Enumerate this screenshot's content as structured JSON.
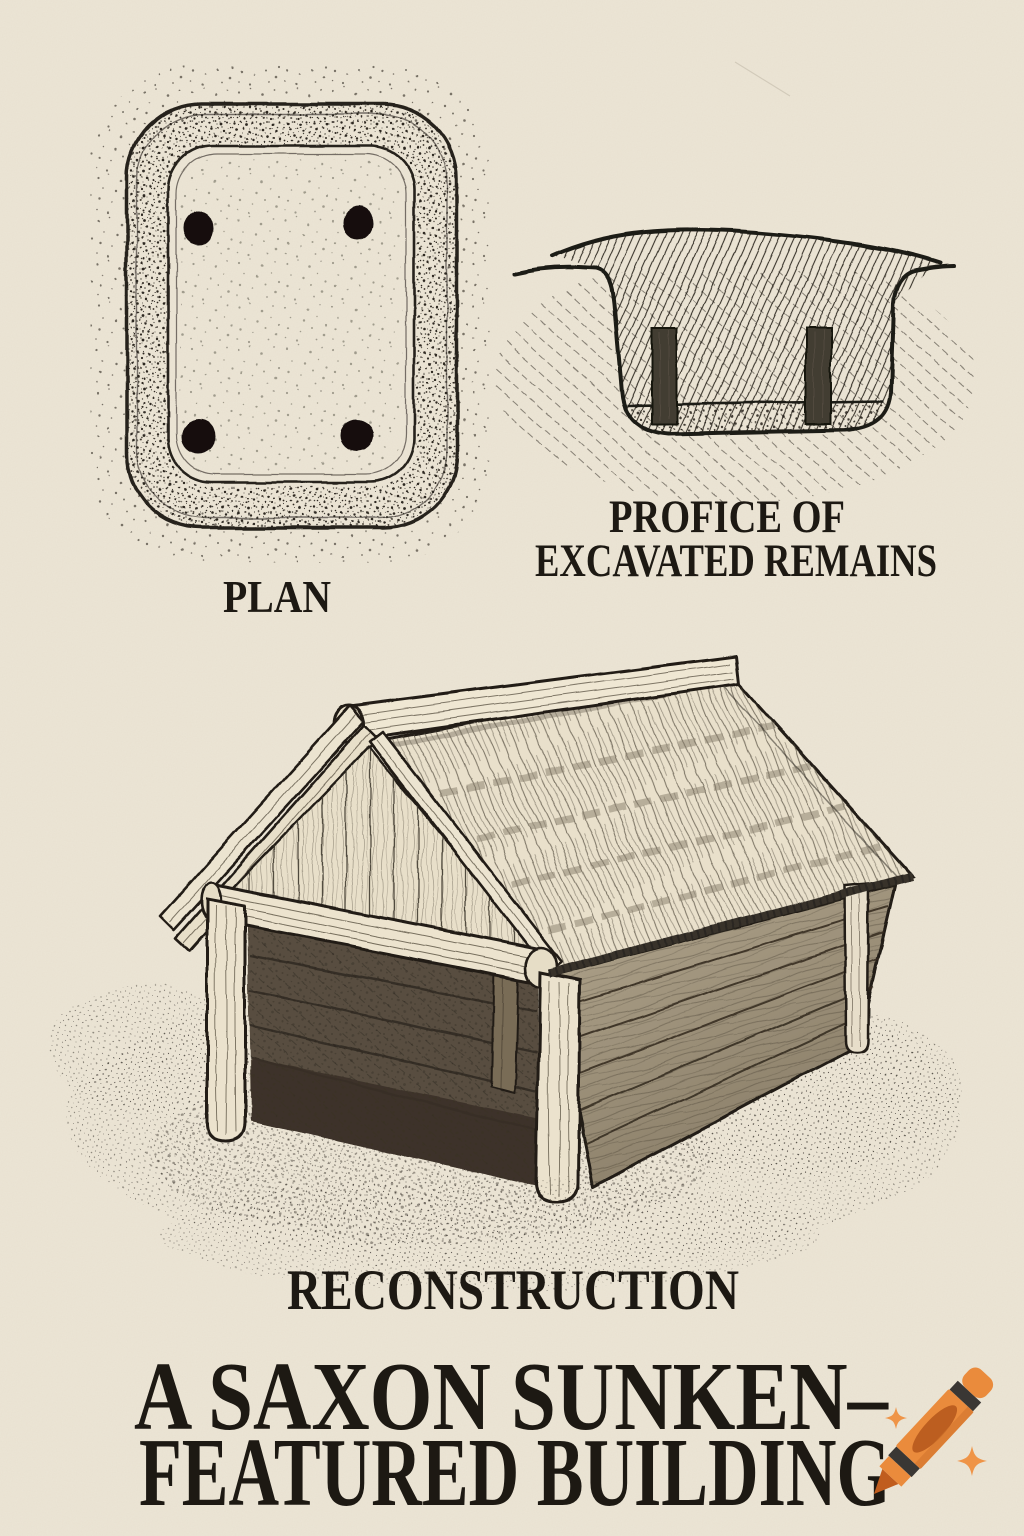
{
  "page": {
    "background_color": "#ece5d5",
    "ink_color": "#1f1b15",
    "description": "Archaeological pen-and-ink style illustration of a Saxon sunken-featured building"
  },
  "figure": {
    "plan": {
      "label": "PLAN"
    },
    "profile": {
      "label_line1": "PROFICE OF",
      "label_line2": "EXCAVATED REMAINS"
    },
    "reconstruction": {
      "label": "RECONSTRUCTION"
    }
  },
  "title": {
    "line1": "A SAXON SUNKEN–",
    "line2": "FEATURED BUILDING"
  },
  "watermark": {
    "icon": "crayon-icon",
    "body_color": "#ea8b3c",
    "tip_color": "#c05d1e",
    "stripe_color": "#3a3734",
    "oval_color": "#bc5e20",
    "sparkle_color": "#ef9447"
  }
}
